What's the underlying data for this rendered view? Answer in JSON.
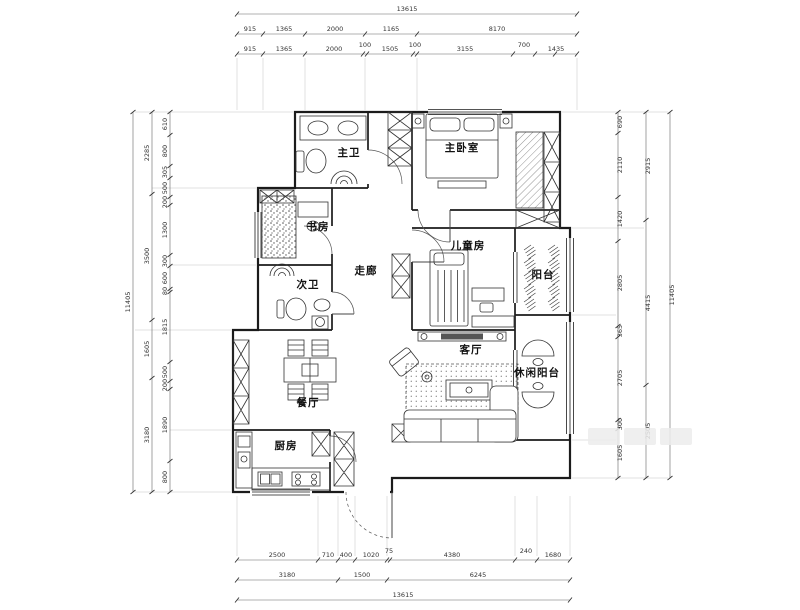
{
  "drawing": {
    "background": "#ffffff",
    "wall_color": "#1b1b1b",
    "dim_color": "#555555"
  },
  "rooms": [
    {
      "name": "master-bath-label",
      "label": "主卫",
      "x": 349,
      "y": 156,
      "size": 10.5
    },
    {
      "name": "master-bedroom-label",
      "label": "主卧室",
      "x": 462,
      "y": 151,
      "size": 12
    },
    {
      "name": "study-label",
      "label": "书房",
      "x": 318,
      "y": 230,
      "size": 10.5
    },
    {
      "name": "kids-room-label",
      "label": "儿童房",
      "x": 468,
      "y": 249,
      "size": 10.5
    },
    {
      "name": "second-bath-label",
      "label": "次卫",
      "x": 308,
      "y": 288,
      "size": 10.5
    },
    {
      "name": "corridor-label",
      "label": "走廊",
      "x": 366,
      "y": 274,
      "size": 10.5
    },
    {
      "name": "balcony-label",
      "label": "阳台",
      "x": 543,
      "y": 278,
      "size": 8
    },
    {
      "name": "living-room-label",
      "label": "客厅",
      "x": 471,
      "y": 353,
      "size": 10.5
    },
    {
      "name": "leisure-balcony-label",
      "label": "休闲阳台",
      "x": 537,
      "y": 376,
      "size": 9
    },
    {
      "name": "dining-room-label",
      "label": "餐厅",
      "x": 308,
      "y": 406,
      "size": 10.5
    },
    {
      "name": "kitchen-label",
      "label": "厨房",
      "x": 286,
      "y": 449,
      "size": 10.5
    }
  ],
  "dim_labels": [
    {
      "t": "13615",
      "x": 407,
      "y": 11
    },
    {
      "t": "915",
      "x": 250,
      "y": 31
    },
    {
      "t": "1365",
      "x": 284,
      "y": 31
    },
    {
      "t": "2000",
      "x": 335,
      "y": 31
    },
    {
      "t": "1165",
      "x": 391,
      "y": 31
    },
    {
      "t": "8170",
      "x": 497,
      "y": 31
    },
    {
      "t": "915",
      "x": 250,
      "y": 51
    },
    {
      "t": "1365",
      "x": 284,
      "y": 51
    },
    {
      "t": "2000",
      "x": 334,
      "y": 51
    },
    {
      "t": "100",
      "x": 365,
      "y": 47
    },
    {
      "t": "1505",
      "x": 390,
      "y": 51
    },
    {
      "t": "100",
      "x": 415,
      "y": 47
    },
    {
      "t": "3155",
      "x": 465,
      "y": 51
    },
    {
      "t": "700",
      "x": 524,
      "y": 47
    },
    {
      "t": "1435",
      "x": 556,
      "y": 51
    },
    {
      "t": "2500",
      "x": 277,
      "y": 557
    },
    {
      "t": "710",
      "x": 328,
      "y": 557
    },
    {
      "t": "400",
      "x": 346,
      "y": 557
    },
    {
      "t": "1020",
      "x": 371,
      "y": 557
    },
    {
      "t": "75",
      "x": 389,
      "y": 553
    },
    {
      "t": "4380",
      "x": 452,
      "y": 557
    },
    {
      "t": "240",
      "x": 526,
      "y": 553
    },
    {
      "t": "1680",
      "x": 553,
      "y": 557
    },
    {
      "t": "3180",
      "x": 287,
      "y": 577
    },
    {
      "t": "1500",
      "x": 362,
      "y": 577
    },
    {
      "t": "6245",
      "x": 478,
      "y": 577
    },
    {
      "t": "13615",
      "x": 403,
      "y": 597
    },
    {
      "t": "610",
      "x": 167,
      "y": 124,
      "r": -90
    },
    {
      "t": "800",
      "x": 167,
      "y": 151,
      "r": -90
    },
    {
      "t": "305",
      "x": 167,
      "y": 172,
      "r": -90
    },
    {
      "t": "500",
      "x": 167,
      "y": 188,
      "r": -90
    },
    {
      "t": "200",
      "x": 167,
      "y": 202,
      "r": -90
    },
    {
      "t": "1300",
      "x": 167,
      "y": 230,
      "r": -90
    },
    {
      "t": "300",
      "x": 167,
      "y": 261,
      "r": -90
    },
    {
      "t": "600",
      "x": 167,
      "y": 278,
      "r": -90
    },
    {
      "t": "80",
      "x": 167,
      "y": 291,
      "r": -90
    },
    {
      "t": "1815",
      "x": 167,
      "y": 327,
      "r": -90
    },
    {
      "t": "500",
      "x": 167,
      "y": 372,
      "r": -90
    },
    {
      "t": "200",
      "x": 167,
      "y": 385,
      "r": -90
    },
    {
      "t": "1890",
      "x": 167,
      "y": 425,
      "r": -90
    },
    {
      "t": "800",
      "x": 167,
      "y": 477,
      "r": -90
    },
    {
      "t": "2285",
      "x": 149,
      "y": 153,
      "r": -90
    },
    {
      "t": "3500",
      "x": 149,
      "y": 256,
      "r": -90
    },
    {
      "t": "1605",
      "x": 149,
      "y": 349,
      "r": -90
    },
    {
      "t": "3180",
      "x": 149,
      "y": 435,
      "r": -90
    },
    {
      "t": "11405",
      "x": 130,
      "y": 302,
      "r": -90
    },
    {
      "t": "690",
      "x": 622,
      "y": 122,
      "r": -90
    },
    {
      "t": "2110",
      "x": 622,
      "y": 165,
      "r": -90
    },
    {
      "t": "1420",
      "x": 622,
      "y": 219,
      "r": -90
    },
    {
      "t": "2805",
      "x": 622,
      "y": 283,
      "r": -90
    },
    {
      "t": "365",
      "x": 622,
      "y": 331,
      "r": -90
    },
    {
      "t": "2705",
      "x": 622,
      "y": 378,
      "r": -90
    },
    {
      "t": "300",
      "x": 622,
      "y": 424,
      "r": -90
    },
    {
      "t": "1605",
      "x": 622,
      "y": 453,
      "r": -90
    },
    {
      "t": "2915",
      "x": 650,
      "y": 166,
      "r": -90
    },
    {
      "t": "4415",
      "x": 650,
      "y": 303,
      "r": -90
    },
    {
      "t": "2505",
      "x": 650,
      "y": 431,
      "r": -90
    },
    {
      "t": "11405",
      "x": 674,
      "y": 295,
      "r": -90
    }
  ]
}
